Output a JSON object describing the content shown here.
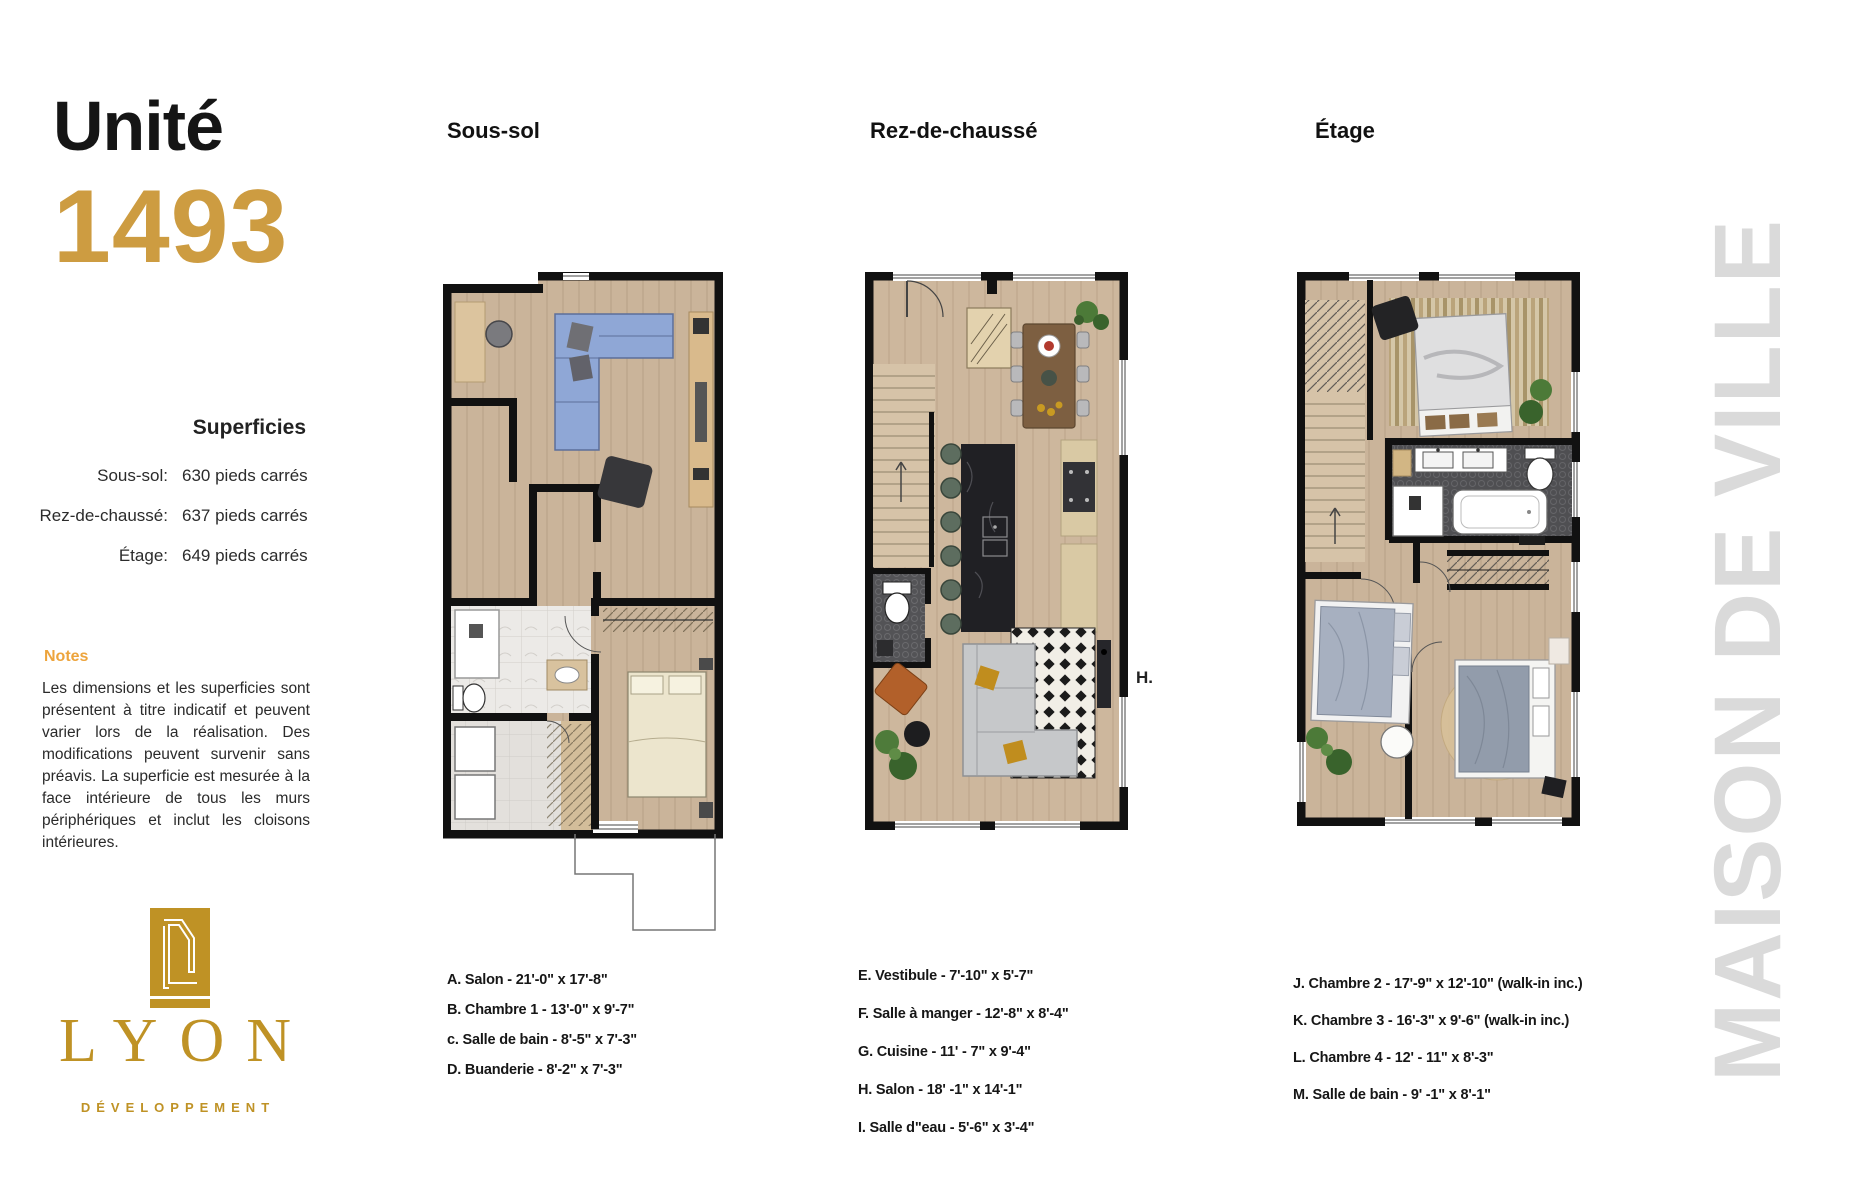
{
  "unit": {
    "label": "Unité",
    "number": "1493"
  },
  "superficies": {
    "title": "Superficies",
    "rows": [
      {
        "label": "Sous-sol:",
        "value": "630 pieds carrés"
      },
      {
        "label": "Rez-de-chaussé:",
        "value": "637 pieds carrés"
      },
      {
        "label": "Étage:",
        "value": "649 pieds carrés"
      }
    ]
  },
  "notes": {
    "title": "Notes",
    "body": "Les dimensions et les superficies sont présentent à titre indicatif et peuvent varier lors de la réalisation. Des modifications peuvent survenir sans préavis. La superficie est mesurée à la face intérieure de tous les murs périphériques et inclut les cloisons intérieures."
  },
  "logo": {
    "name": "LYON",
    "tagline": "DÉVELOPPEMENT"
  },
  "plans": [
    {
      "title": "Sous-sol",
      "rooms": [
        "A. Salon -  21'-0\" x 17'-8\"",
        "B. Chambre 1 - 13'-0\" x  9'-7\"",
        "c. Salle de bain - 8'-5\" x 7'-3\"",
        "D. Buanderie  -  8'-2\" x 7'-3\""
      ]
    },
    {
      "title": "Rez-de-chaussé",
      "annotation": "H.",
      "rooms": [
        "E. Vestibule -  7'-10\" x 5'-7\"",
        "F. Salle à manger - 12'-8\"  x  8'-4\"",
        "G. Cuisine - 11' - 7\" x 9'-4\"",
        "H. Salon  -  18' -1\"  x  14'-1\"",
        "I.  Salle d\"eau - 5'-6\" x 3'-4\""
      ]
    },
    {
      "title": "Étage",
      "rooms": [
        "J. Chambre 2 -  17'-9\" x 12'-10\" (walk-in inc.)",
        "K. Chambre 3 -  16'-3\"  x  9'-6\"  (walk-in inc.)",
        "L. Chambre 4 - 12' - 11\" x 8'-3\"",
        "M. Salle de bain -  9' -1\"  x  8'-1\""
      ]
    }
  ],
  "side_text": "MAISON DE VILLE",
  "colors": {
    "gold_number": "#cd9c41",
    "gold_logo": "#bf9225",
    "notes_orange": "#eda43c",
    "side_gray": "#dadada",
    "wall_black": "#111111",
    "floor_beige": "#cab49a"
  }
}
